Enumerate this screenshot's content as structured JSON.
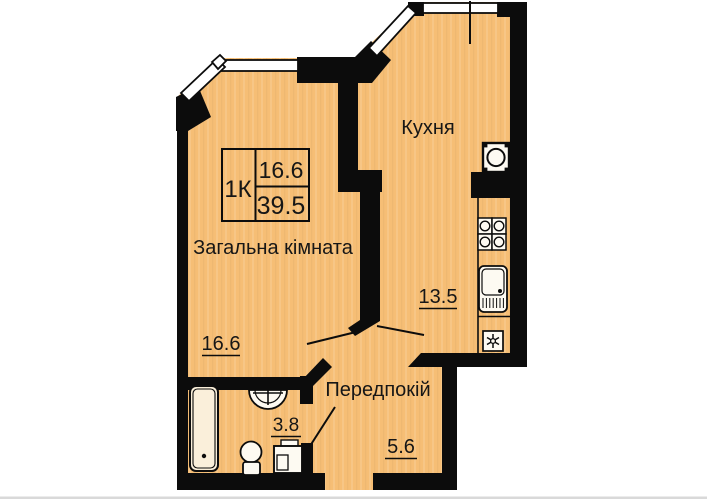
{
  "plan": {
    "legend": {
      "apartment_type": "1К",
      "living_area": "16.6",
      "total_area": "39.5"
    },
    "rooms": {
      "kitchen": {
        "name": "Кухня",
        "area": "13.5"
      },
      "living": {
        "name": "Загальна кімната",
        "area": "16.6"
      },
      "hallway": {
        "name": "Передпокій",
        "area": "5.6"
      },
      "bathroom": {
        "area": "3.8"
      }
    }
  },
  "colors": {
    "floor": "#F6BE75",
    "wall": "#0C0C0C",
    "fixture": "#FDFAF2",
    "tub": "#FAEFDA",
    "text": "#161616"
  }
}
